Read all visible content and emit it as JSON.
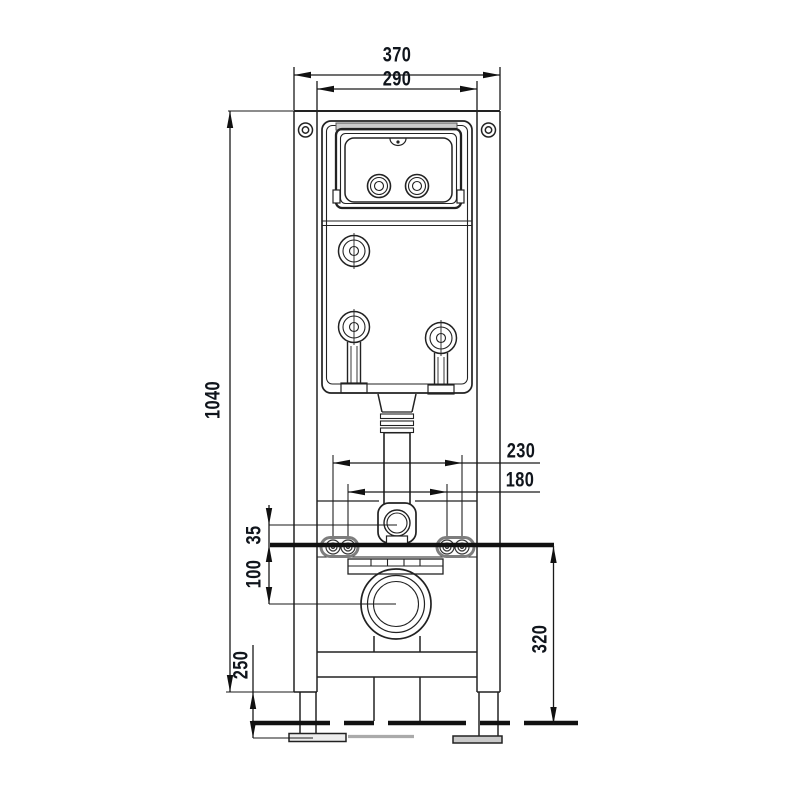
{
  "drawing": {
    "kind": "installation-frame-front-view",
    "colors": {
      "background": "#ffffff",
      "line": "#222222",
      "thick_line": "#111111",
      "dim_text": "#10151c",
      "plate_outline": "#7d7d7d",
      "lid_band": "#cccccc",
      "foot_plate": "#c9c9c9"
    },
    "dimensions": {
      "outer_width": "370",
      "inner_width": "290",
      "frame_height": "1040",
      "bolt_spacing_outer": "230",
      "bolt_spacing_inner": "180",
      "flush_elbow_offset": "35",
      "waste_outlet_offset": "100",
      "leg_adjustment": "250",
      "fixing_height": "320"
    }
  }
}
